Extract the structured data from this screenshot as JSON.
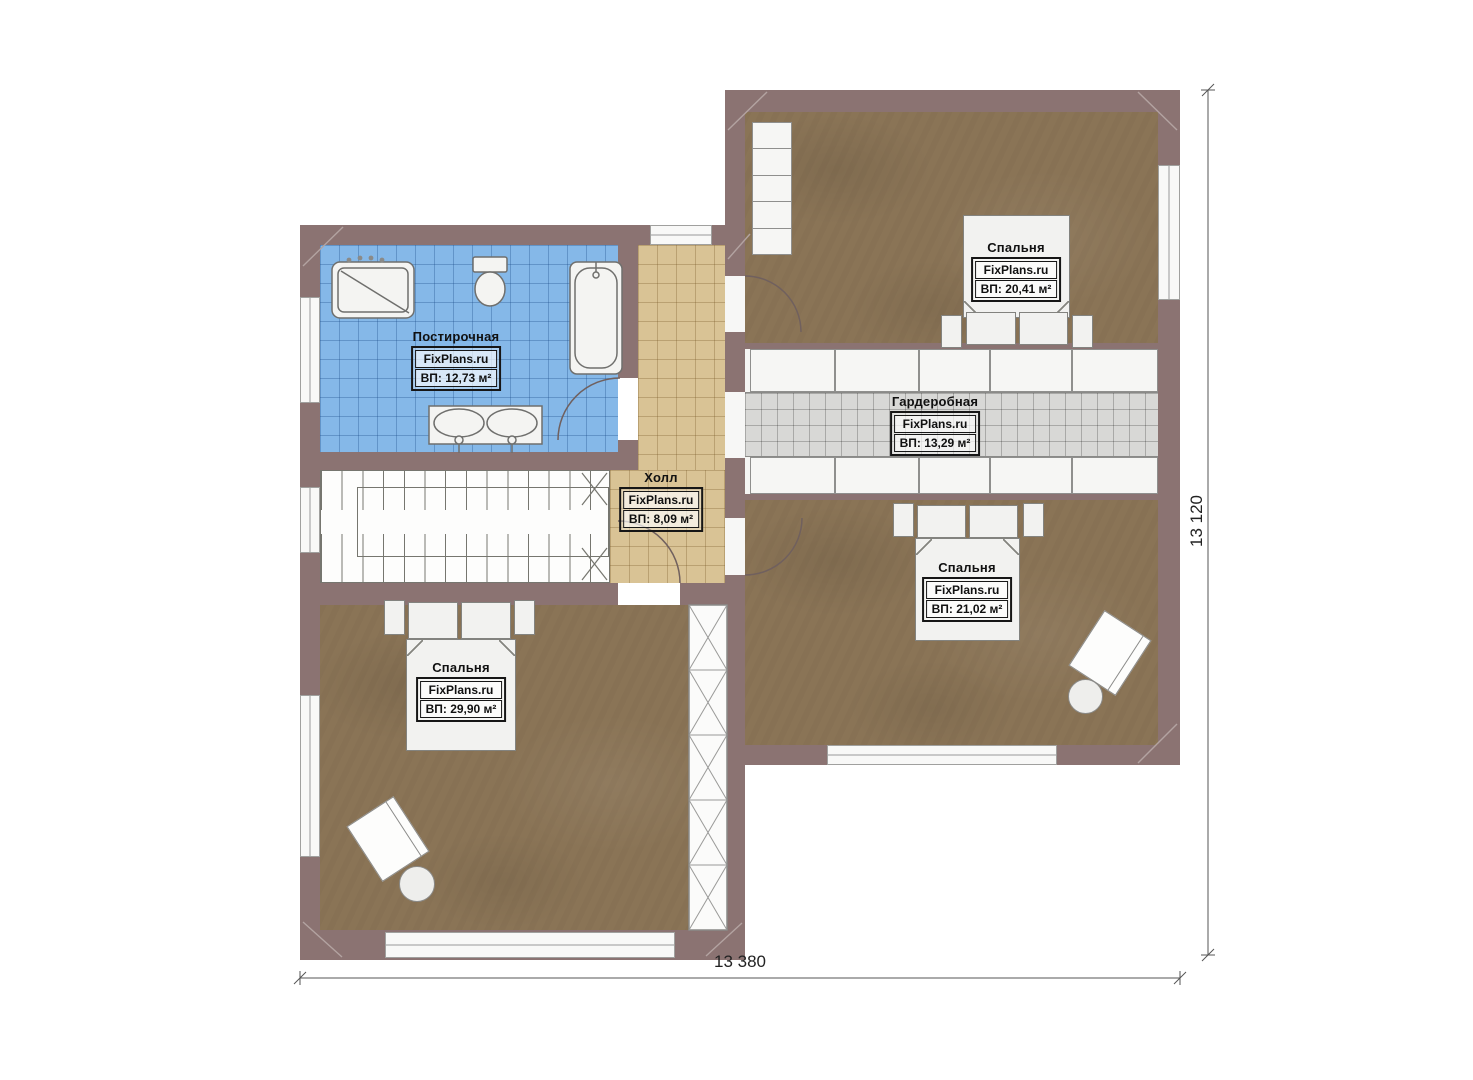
{
  "rooms": {
    "laundry": {
      "name": "Постирочная",
      "brand": "FixPlans.ru",
      "area": "ВП: 12,73 м²"
    },
    "hall": {
      "name": "Холл",
      "brand": "FixPlans.ru",
      "area": "ВП: 8,09 м²"
    },
    "wardrobe": {
      "name": "Гардеробная",
      "brand": "FixPlans.ru",
      "area": "ВП: 13,29 м²"
    },
    "bedroom_top": {
      "name": "Спальня",
      "brand": "FixPlans.ru",
      "area": "ВП: 20,41 м²"
    },
    "bedroom_right": {
      "name": "Спальня",
      "brand": "FixPlans.ru",
      "area": "ВП: 21,02 м²"
    },
    "bedroom_left": {
      "name": "Спальня",
      "brand": "FixPlans.ru",
      "area": "ВП: 29,90 м²"
    }
  },
  "dimensions": {
    "overall_width": "13 380",
    "overall_height": "13 120"
  },
  "colors": {
    "wall": "#8b7372",
    "wood_floor": "#8a7456",
    "tile_blue": "#85b8e8",
    "tile_tan": "#d9c395",
    "tile_gray": "#d8d8d6",
    "fixture_white": "#f5f5f3",
    "label_border": "#161616"
  }
}
